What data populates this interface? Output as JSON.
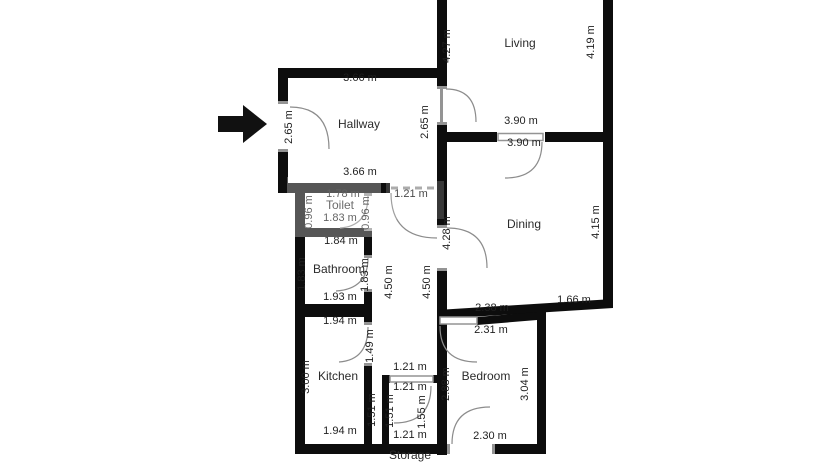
{
  "plan_title": "Apartment floor plan",
  "colors": {
    "background": "#ffffff",
    "wall": "#0d0d0d",
    "door_symbol": "#949494",
    "arc": "#8c8c8c",
    "dimension_text": "#1f1f1f",
    "room_text": "#2b2b2b",
    "entrance_arrow": "#111111"
  },
  "entrance": {
    "symbol": "arrow",
    "direction": "right",
    "into_room": "Hallway"
  },
  "watermark": {
    "present": true,
    "style": "faint white patches over center walls"
  },
  "rooms": [
    {
      "name": "Living",
      "x": 520,
      "y": 47
    },
    {
      "name": "Hallway",
      "x": 359,
      "y": 128
    },
    {
      "name": "Toilet",
      "x": 340,
      "y": 209
    },
    {
      "name": "Dining",
      "x": 524,
      "y": 228
    },
    {
      "name": "Bathroom",
      "x": 339,
      "y": 273
    },
    {
      "name": "Kitchen",
      "x": 338,
      "y": 380
    },
    {
      "name": "Bedroom",
      "x": 486,
      "y": 380
    },
    {
      "name": "Storage",
      "x": 410,
      "y": 459
    }
  ],
  "dimensions": [
    {
      "text": "3.66 m",
      "x": 360,
      "y": 81,
      "rot": 0
    },
    {
      "text": "2.65 m",
      "x": 292,
      "y": 127,
      "rot": -90
    },
    {
      "text": "2.65 m",
      "x": 428,
      "y": 122,
      "rot": -90
    },
    {
      "text": "3.66 m",
      "x": 360,
      "y": 175,
      "rot": 0
    },
    {
      "text": "4.27 m",
      "x": 450,
      "y": 46,
      "rot": -90
    },
    {
      "text": "4.19 m",
      "x": 594,
      "y": 42,
      "rot": -90
    },
    {
      "text": "3.90 m",
      "x": 521,
      "y": 124,
      "rot": 0
    },
    {
      "text": "3.90 m",
      "x": 524,
      "y": 146,
      "rot": 0
    },
    {
      "text": "4.15 m",
      "x": 599,
      "y": 222,
      "rot": -90
    },
    {
      "text": "4.28 m",
      "x": 450,
      "y": 233,
      "rot": -90
    },
    {
      "text": "1.78 m",
      "x": 343,
      "y": 197,
      "rot": 0
    },
    {
      "text": "1.21 m",
      "x": 411,
      "y": 197,
      "rot": 0
    },
    {
      "text": "0.96 m",
      "x": 312,
      "y": 212,
      "rot": -90
    },
    {
      "text": "0.96 m",
      "x": 369,
      "y": 213,
      "rot": -90
    },
    {
      "text": "1.83 m",
      "x": 340,
      "y": 221,
      "rot": 0
    },
    {
      "text": "1.84 m",
      "x": 341,
      "y": 244,
      "rot": 0
    },
    {
      "text": "1.83 m",
      "x": 305,
      "y": 274,
      "rot": -90
    },
    {
      "text": "1.83 m",
      "x": 368,
      "y": 275,
      "rot": -90
    },
    {
      "text": "4.50 m",
      "x": 392,
      "y": 282,
      "rot": -90
    },
    {
      "text": "4.50 m",
      "x": 430,
      "y": 282,
      "rot": -90
    },
    {
      "text": "1.93 m",
      "x": 340,
      "y": 300,
      "rot": 0
    },
    {
      "text": "2.38 m",
      "x": 492,
      "y": 311,
      "rot": 0
    },
    {
      "text": "1.66 m",
      "x": 574,
      "y": 303,
      "rot": 0
    },
    {
      "text": "1.94 m",
      "x": 340,
      "y": 324,
      "rot": 0
    },
    {
      "text": "2.31 m",
      "x": 491,
      "y": 333,
      "rot": 0
    },
    {
      "text": "1.49 m",
      "x": 373,
      "y": 346,
      "rot": -90
    },
    {
      "text": "3.00 m",
      "x": 309,
      "y": 377,
      "rot": -90
    },
    {
      "text": "1.21 m",
      "x": 410,
      "y": 370,
      "rot": 0
    },
    {
      "text": "1.21 m",
      "x": 410,
      "y": 390,
      "rot": 0
    },
    {
      "text": "2.88 m",
      "x": 449,
      "y": 384,
      "rot": -90
    },
    {
      "text": "3.04 m",
      "x": 528,
      "y": 384,
      "rot": -90
    },
    {
      "text": "1.51 m",
      "x": 375,
      "y": 410,
      "rot": -90
    },
    {
      "text": "1.51 m",
      "x": 393,
      "y": 411,
      "rot": -90
    },
    {
      "text": "1.55 m",
      "x": 425,
      "y": 412,
      "rot": -90
    },
    {
      "text": "1.94 m",
      "x": 340,
      "y": 434,
      "rot": 0
    },
    {
      "text": "1.21 m",
      "x": 410,
      "y": 438,
      "rot": 0
    },
    {
      "text": "2.30 m",
      "x": 490,
      "y": 439,
      "rot": 0
    }
  ]
}
